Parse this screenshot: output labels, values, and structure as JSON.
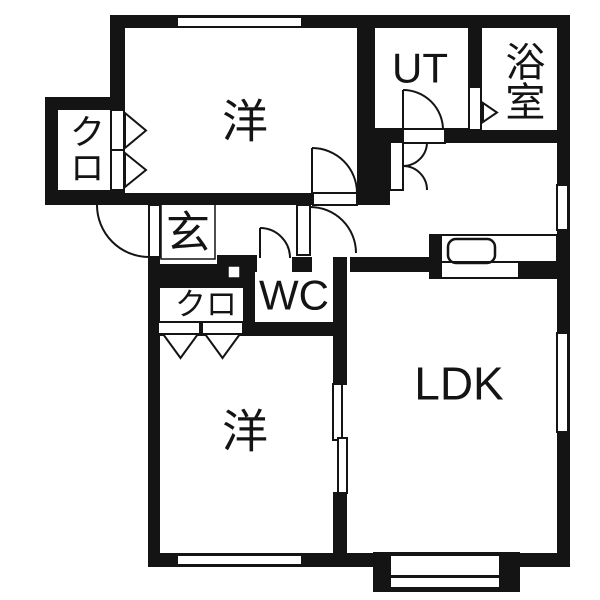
{
  "plan_type": "floor-plan",
  "colors": {
    "wall": "#141414",
    "background": "#ffffff",
    "line": "#141414"
  },
  "rooms": {
    "bedroom1": {
      "label": "洋"
    },
    "utility": {
      "label": "UT"
    },
    "bathroom": {
      "label": "浴室"
    },
    "closet1": {
      "label": "クロ"
    },
    "entrance": {
      "label": "玄"
    },
    "closet2": {
      "label": "クロ"
    },
    "toilet": {
      "label": "WC"
    },
    "ldk": {
      "label": "LDK"
    },
    "bedroom2": {
      "label": "洋"
    }
  }
}
